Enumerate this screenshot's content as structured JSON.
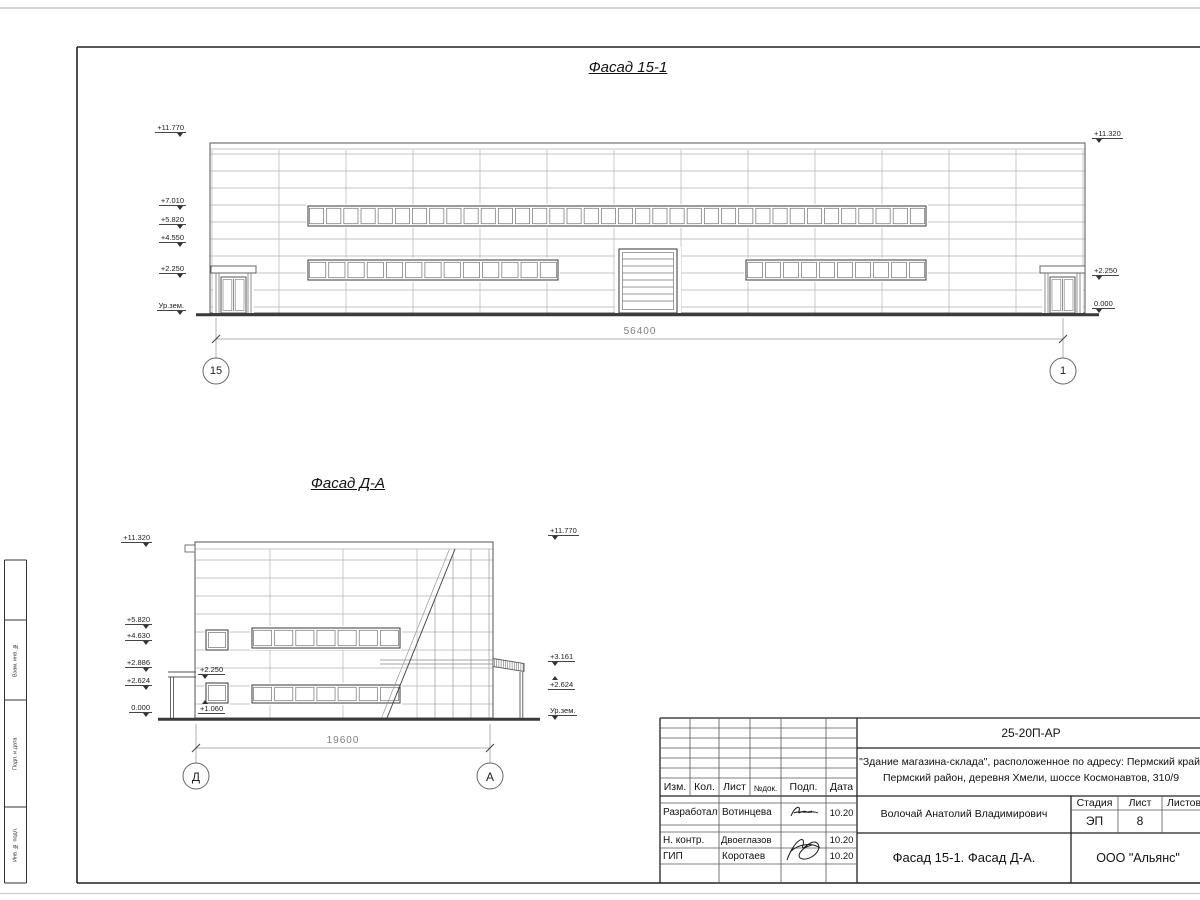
{
  "sheet": {
    "facade1": {
      "title": "Фасад 15-1",
      "dim": "56400",
      "axis_left": "15",
      "axis_right": "1",
      "marks_left": [
        "+11.770",
        "+7.010",
        "+5.820",
        "+4.550",
        "+2.250",
        "Ур.зем."
      ],
      "marks_right": [
        "+11.320",
        "+2.250",
        "0.000"
      ]
    },
    "facade2": {
      "title": "Фасад Д-А",
      "dim": "19600",
      "axis_left": "Д",
      "axis_right": "А",
      "marks_left": [
        "+11.320",
        "+5.820",
        "+4.630",
        "+2.886",
        "+2.624",
        "0.000"
      ],
      "marks_inner": [
        "+2.250",
        "+1.060"
      ],
      "marks_right": [
        "+11.770",
        "+3.161",
        "+2.624",
        "Ур.зем."
      ]
    },
    "titleblock": {
      "code": "25-20П-АР",
      "project_line1": "\"Здание магазина-склада\", расположенное по адресу: Пермский край,",
      "project_line2": "Пермский район, деревня Хмели, шоссе Космонавтов, 310/9",
      "col_izm": "Изм.",
      "col_kol": "Кол.",
      "col_list": "Лист",
      "col_ndok": "№док.",
      "col_podp": "Подп.",
      "col_data": "Дата",
      "stage_label": "Стадия",
      "list_label": "Лист",
      "listov_label": "Листов",
      "stage": "ЭП",
      "sheet_number": "8",
      "developed_label": "Разработал",
      "developed_name": "Вотинцева",
      "developed_date": "10.20",
      "ncontr_label": "Н. контр.",
      "ncontr_name": "Двоеглазов",
      "ncontr_date": "10.20",
      "gip_label": "ГИП",
      "gip_name": "Коротаев",
      "gip_date": "10.20",
      "chief_name": "Волочай Анатолий Владимирович",
      "drawing_name": "Фасад 15-1. Фасад Д-А.",
      "company": "ООО \"Альянс\""
    },
    "side_stamp": {
      "cell1": "Взам. инв. №",
      "cell2": "Подп. и дата",
      "cell3": "Инв. № подл."
    }
  }
}
